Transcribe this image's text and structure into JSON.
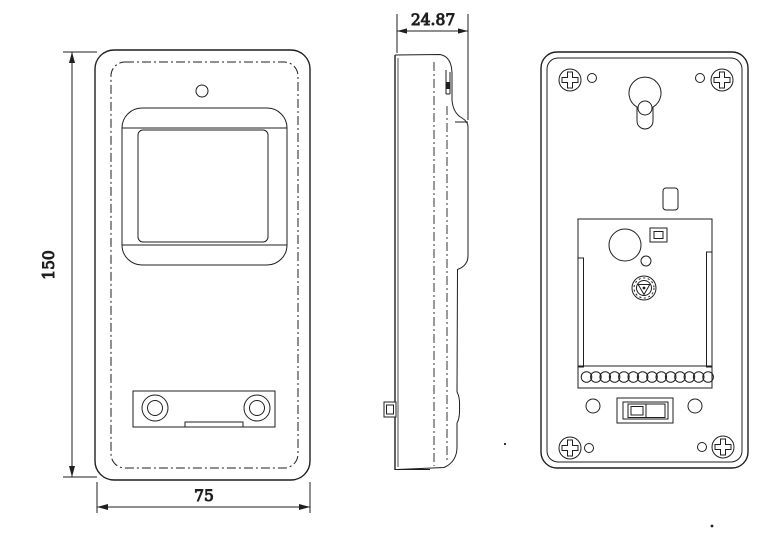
{
  "page": {
    "background": "#ffffff",
    "line_color": "#1f1f1f"
  },
  "drawing": {
    "kind": "orthographic-technical-drawing",
    "dimensions": {
      "height": "150",
      "width": "75",
      "depth": "24.87"
    }
  }
}
